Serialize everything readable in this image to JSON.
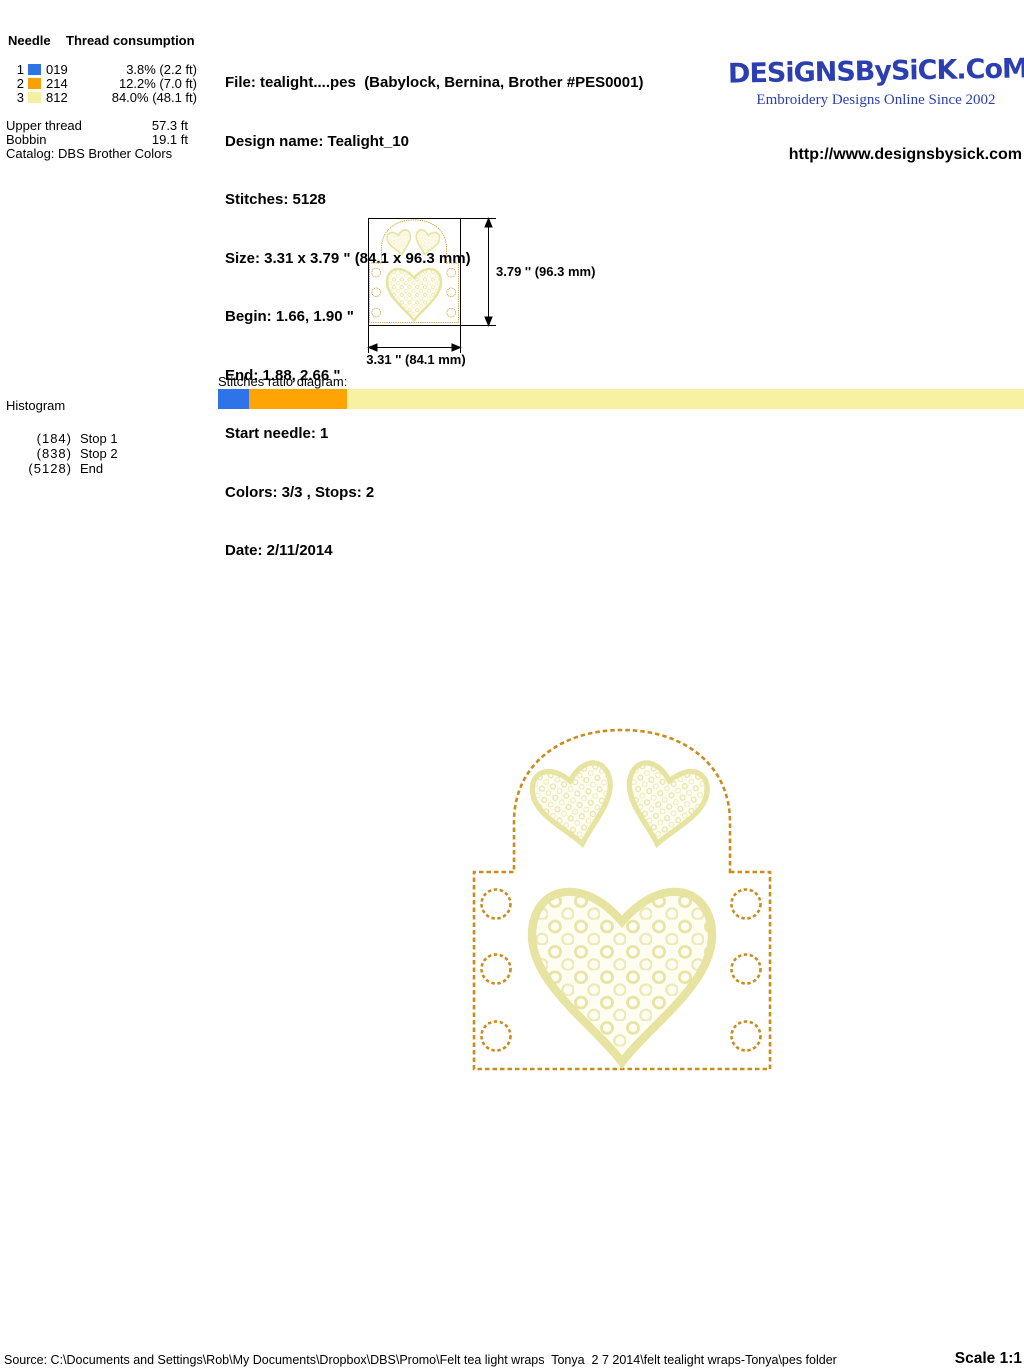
{
  "needle_panel": {
    "header_needle": "Needle",
    "header_consumption": "Thread consumption",
    "rows": [
      {
        "num": "1",
        "color": "#2e74e8",
        "code": "019",
        "usage": "3.8% (2.2 ft)"
      },
      {
        "num": "2",
        "color": "#f7a104",
        "code": "214",
        "usage": "12.2% (7.0 ft)"
      },
      {
        "num": "3",
        "color": "#f6eea0",
        "code": "812",
        "usage": "84.0% (48.1 ft)"
      }
    ],
    "upper_thread_label": "Upper thread",
    "upper_thread_value": "57.3 ft",
    "bobbin_label": "Bobbin",
    "bobbin_value": "19.1 ft",
    "catalog_line": "Catalog: DBS Brother Colors"
  },
  "file_info": {
    "lines": [
      "File: tealight....pes  (Babylock, Bernina, Brother #PES0001)",
      "Design name: Tealight_10",
      "Stitches: 5128",
      "Size: 3.31 x 3.79 \" (84.1 x 96.3 mm)",
      "Begin: 1.66, 1.90 \"",
      "End: 1.88, 2.66 \"",
      "Start needle: 1",
      "Colors: 3/3 , Stops: 2",
      "Date: 2/11/2014"
    ]
  },
  "brand": {
    "logo": "DESiGNSBySiCK.CoM",
    "tagline": "Embroidery Designs Online Since 2002",
    "url": "http://www.designsbysick.com",
    "blue": "#2b3fb0"
  },
  "dimensions": {
    "height_label": "3.79 '' (96.3 mm)",
    "width_label": "3.31 '' (84.1 mm)"
  },
  "ratio": {
    "label": "Stitches ratio diagram:",
    "segments": [
      {
        "needle": "1",
        "color": "#2e74e8",
        "percent": 3.8
      },
      {
        "needle": "2",
        "color": "#ffa404",
        "percent": 12.2
      },
      {
        "needle": "3",
        "color": "#f9f1a2",
        "percent": 84.0
      }
    ]
  },
  "histogram": {
    "title": "Histogram",
    "entries": [
      {
        "count": "(184)",
        "label": "Stop 1"
      },
      {
        "count": "(838)",
        "label": "Stop 2"
      },
      {
        "count": "(5128)",
        "label": "End"
      }
    ]
  },
  "design": {
    "description": "Felt tealight wrap with three lace hearts and six eyelet circles",
    "outline_color": "#c98d1d",
    "satin_color": "#e7e3a0",
    "lace_bg": "#fffdf2",
    "lace_ring": "#e7e4a6"
  },
  "footer": {
    "source": "Source: C:\\Documents and Settings\\Rob\\My Documents\\Dropbox\\DBS\\Promo\\Felt tea light wraps  Tonya  2 7 2014\\felt tealight wraps-Tonya\\pes folder",
    "scale": "Scale 1:1"
  }
}
